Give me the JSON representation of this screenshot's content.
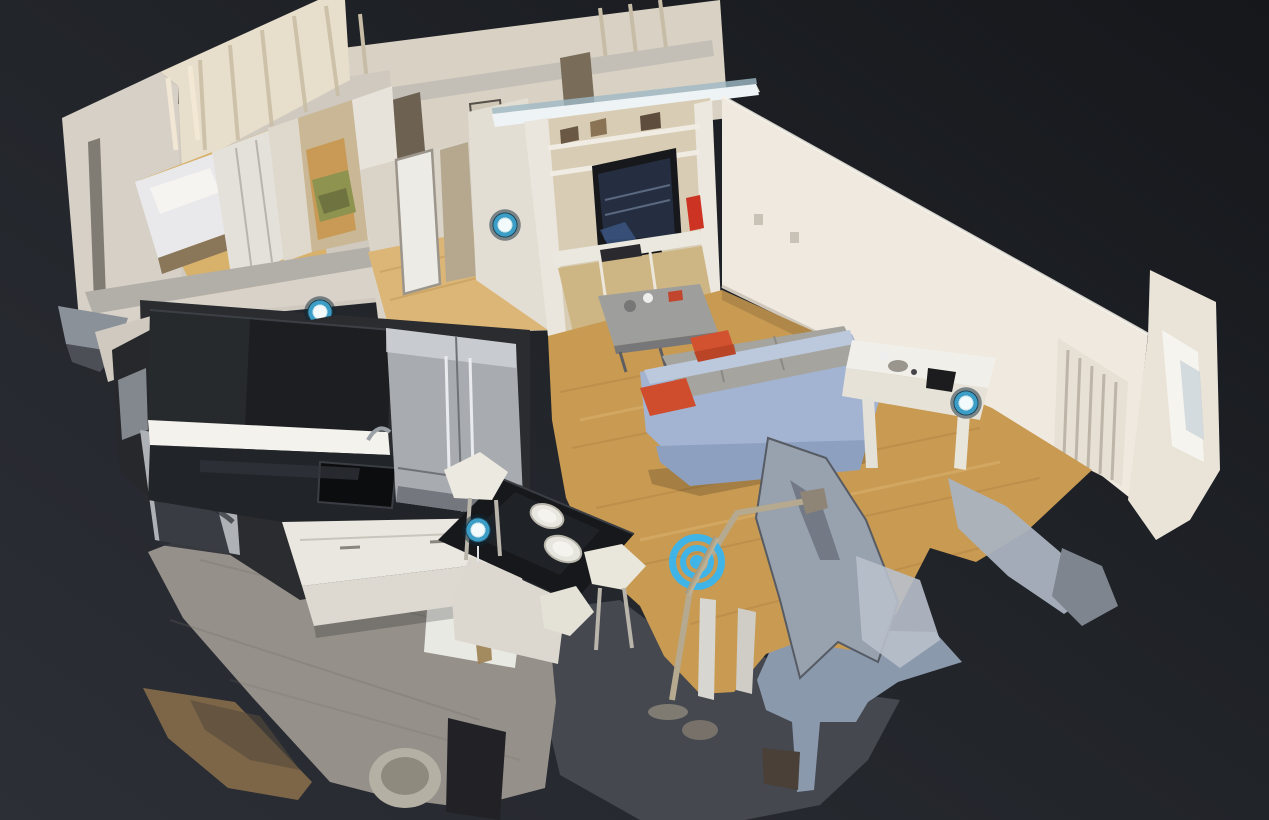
{
  "viewer": {
    "background": {
      "gradient_start": "#15171b",
      "gradient_mid": "#212429",
      "gradient_end": "#2c2f36"
    },
    "waypoints": [
      {
        "id": "hallway",
        "x": 505,
        "y": 225,
        "occluded": false
      },
      {
        "id": "kitchen",
        "x": 320,
        "y": 312,
        "occluded": true
      },
      {
        "id": "kitchen-island",
        "x": 478,
        "y": 530,
        "occluded": false
      },
      {
        "id": "living-room",
        "x": 966,
        "y": 403,
        "occluded": false
      }
    ],
    "waypoint_style": {
      "center": "#f3fafc",
      "ring": "#3c9ec6",
      "halo": "rgba(16,38,52,0.5)",
      "diameter": 34
    },
    "reticle": {
      "x": 697,
      "y": 562,
      "color": "#3cb5ec",
      "diameter": 56
    }
  }
}
